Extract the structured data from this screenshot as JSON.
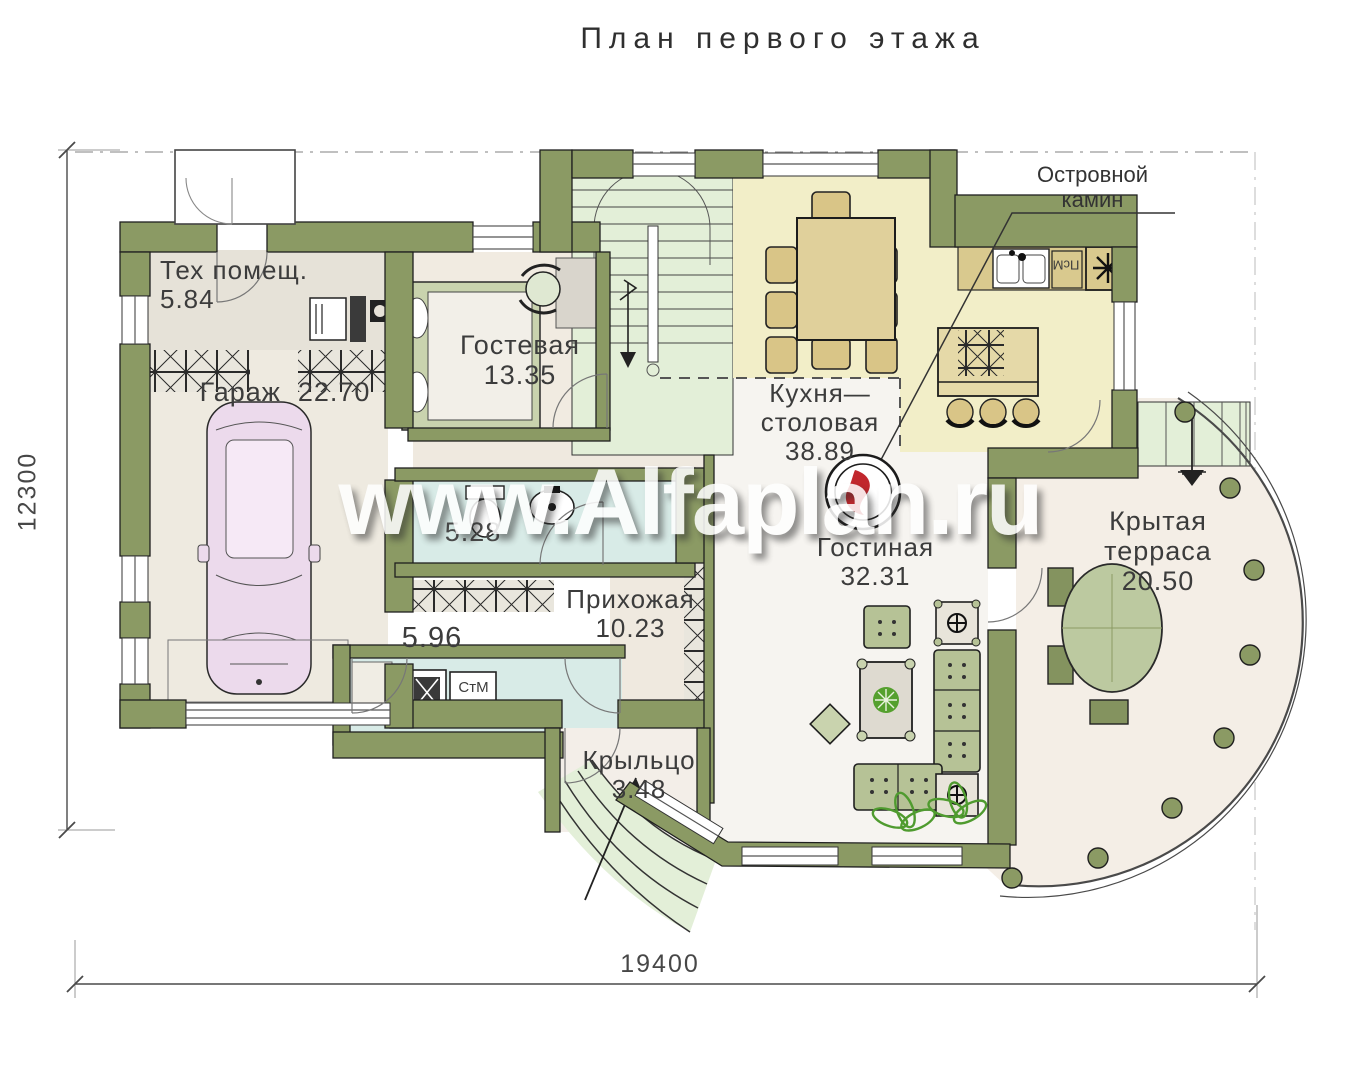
{
  "title": "План первого этажа",
  "watermark": "www.Alfaplan.ru",
  "callout": {
    "line1": "Островной",
    "line2": "камин"
  },
  "dimensions": {
    "vertical": "12300",
    "horizontal": "19400"
  },
  "rooms": {
    "tech": {
      "name": "Тех помещ.",
      "area": "5.84"
    },
    "garage": {
      "name": "Гараж",
      "area": "22.70"
    },
    "guest": {
      "name": "Гостевая",
      "area": "13.35"
    },
    "kitchen": {
      "name_line1": "Кухня—",
      "name_line2": "столовая",
      "area": "38.89"
    },
    "living": {
      "name": "Гостиная",
      "area": "32.31"
    },
    "terrace": {
      "name_line1": "Крытая",
      "name_line2": "терраса",
      "area": "20.50"
    },
    "hall": {
      "name": "Прихожая",
      "area": "10.23"
    },
    "bathroom": {
      "area": "5.28"
    },
    "laundry": {
      "area": "5.96"
    },
    "porch": {
      "name": "Крыльцо",
      "area": "3.48"
    }
  },
  "appliances": {
    "washing_machine": "СтМ",
    "dishwasher": "ПсМ"
  },
  "colors": {
    "wall": "#8b9a64",
    "kitchen_floor": "#f2eec8",
    "wet_floor": "#d8ebe7",
    "stairs_floor": "#e3efd8",
    "flame_accent": "#c1272d",
    "car_body": "#ecdaec"
  }
}
